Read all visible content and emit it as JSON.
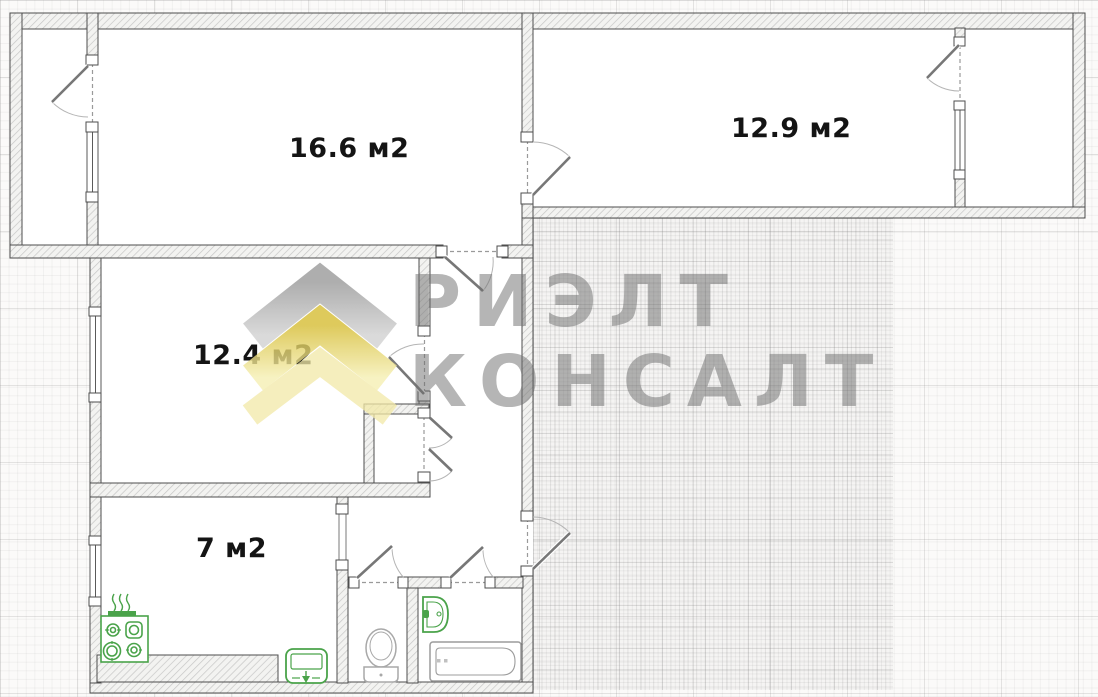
{
  "floor_plan": {
    "type": "apartment-floor-plan",
    "rooms": [
      {
        "name": "living-room",
        "label": "16.6 м2"
      },
      {
        "name": "bedroom",
        "label": "12.9 м2"
      },
      {
        "name": "second-room",
        "label": "12.4 м2"
      },
      {
        "name": "kitchen",
        "label": "7 м2"
      }
    ],
    "unlabeled_areas": [
      "balcony-left",
      "balcony-right",
      "hallway",
      "closet",
      "wc",
      "bathroom"
    ],
    "fixtures": [
      "stove-icon",
      "kitchen-sink-icon",
      "toilet-icon",
      "washbasin-icon",
      "bathtub-icon"
    ],
    "doors": [
      "balcony-left-door",
      "rooms-connecting-door",
      "balcony-right-door",
      "second-room-top-door",
      "second-room-side-door",
      "closet-double-doors",
      "entrance-door",
      "wc-door",
      "bathroom-door",
      "kitchen-opening"
    ]
  },
  "watermark": {
    "line1": "РИЭЛТ",
    "line2": "КОНСАЛТ"
  },
  "colors": {
    "watermark_grey": "#6e6e6e",
    "logo_chevron_grey": "#a0a0a0",
    "logo_chevron_yellow": "#e2ca42",
    "logo_chevron_pale_yellow": "#f1e9a8",
    "fixture_green": "#4aa34a",
    "fixture_grey": "#a0a0a0",
    "wall_outline": "#4d4d4d",
    "label_text": "#141414",
    "paper": "#fbfaf9"
  }
}
